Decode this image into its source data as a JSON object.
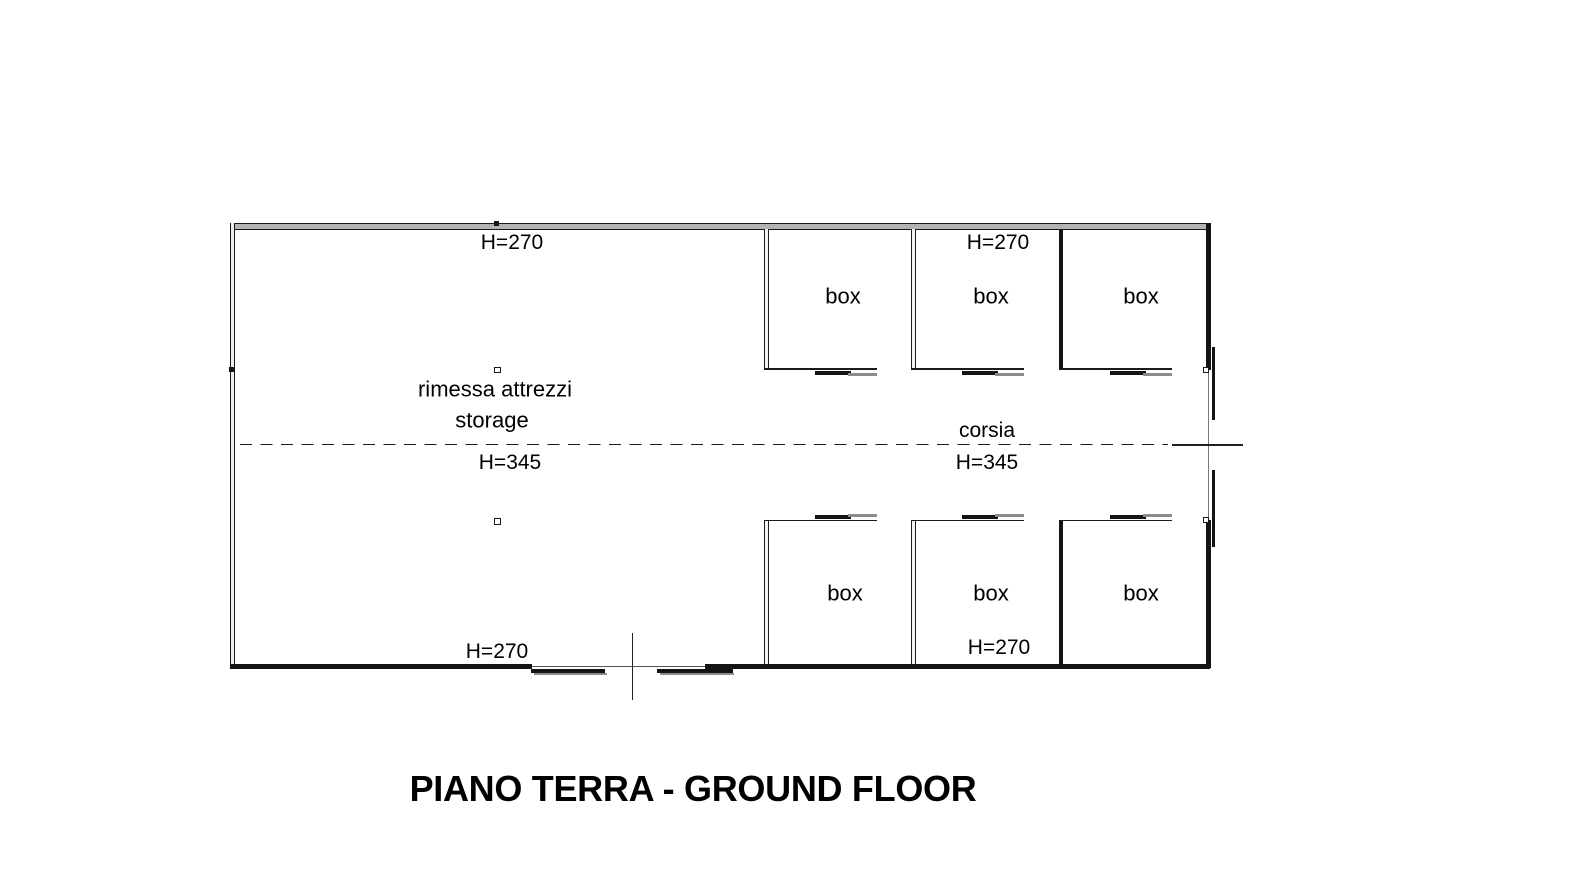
{
  "title": "PIANO TERRA - GROUND FLOOR",
  "plan": {
    "storage": {
      "label_it": "rimessa attrezzi",
      "label_en": "storage",
      "height": "H=345"
    },
    "corridor": {
      "label": "corsia",
      "height": "H=345"
    },
    "heights": {
      "top_left": "H=270",
      "top_right": "H=270",
      "bottom_left": "H=270",
      "bottom_right": "H=270"
    },
    "boxes": [
      {
        "label": "box"
      },
      {
        "label": "box"
      },
      {
        "label": "box"
      },
      {
        "label": "box"
      },
      {
        "label": "box"
      },
      {
        "label": "box"
      }
    ]
  },
  "colors": {
    "ink": "#141414",
    "wall_fill_gray": "#b3b3b3",
    "door_leaf_gray": "#8c8c8c"
  }
}
